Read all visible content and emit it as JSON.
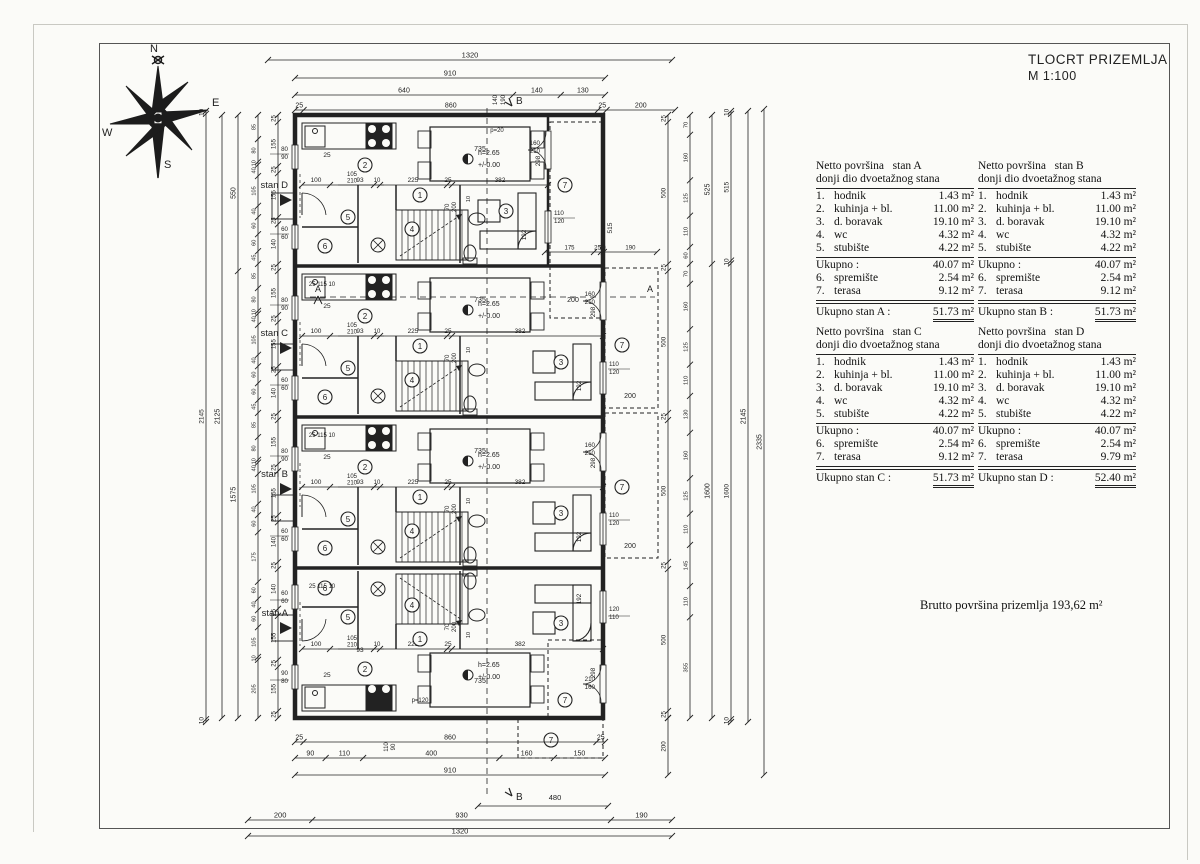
{
  "title_block": {
    "line1": "TLOCRT PRIZEMLJA",
    "line2": "M 1:100"
  },
  "compass": {
    "n": "N",
    "e": "E",
    "s": "S",
    "w": "W"
  },
  "brutto_text": "Brutto površina  prizemlja  193,62 m²",
  "tables": [
    {
      "header": "Netto površina   stan A\ndonji dio dvoetažnog stana",
      "rows": [
        [
          "1.",
          "hodnik",
          "1.43 m²"
        ],
        [
          "2.",
          "kuhinja + bl.",
          "11.00 m²"
        ],
        [
          "3.",
          "d. boravak",
          "19.10 m²"
        ],
        [
          "4.",
          "wc",
          "4.32 m²"
        ],
        [
          "5.",
          "stubište",
          "4.22 m²"
        ]
      ],
      "subtotal_label": "Ukupno :",
      "subtotal": "40.07 m²",
      "extra_rows": [
        [
          "6.",
          "spremište",
          "2.54 m²"
        ],
        [
          "7.",
          "terasa",
          "9.12 m²"
        ]
      ],
      "total_label": "Ukupno stan A :",
      "total": "51.73 m²"
    },
    {
      "header": "Netto površina   stan B\ndonji dio dvoetažnog stana",
      "rows": [
        [
          "1.",
          "hodnik",
          "1.43 m²"
        ],
        [
          "2.",
          "kuhinja + bl.",
          "11.00 m²"
        ],
        [
          "3.",
          "d. boravak",
          "19.10 m²"
        ],
        [
          "4.",
          "wc",
          "4.32 m²"
        ],
        [
          "5.",
          "stubište",
          "4.22 m²"
        ]
      ],
      "subtotal_label": "Ukupno :",
      "subtotal": "40.07 m²",
      "extra_rows": [
        [
          "6.",
          "spremište",
          "2.54 m²"
        ],
        [
          "7.",
          "terasa",
          "9.12 m²"
        ]
      ],
      "total_label": "Ukupno stan B :",
      "total": "51.73 m²"
    },
    {
      "header": "Netto površina   stan C\ndonji dio dvoetažnog stana",
      "rows": [
        [
          "1.",
          "hodnik",
          "1.43 m²"
        ],
        [
          "2.",
          "kuhinja + bl.",
          "11.00 m²"
        ],
        [
          "3.",
          "d. boravak",
          "19.10 m²"
        ],
        [
          "4.",
          "wc",
          "4.32 m²"
        ],
        [
          "5.",
          "stubište",
          "4.22 m²"
        ]
      ],
      "subtotal_label": "Ukupno :",
      "subtotal": "40.07 m²",
      "extra_rows": [
        [
          "6.",
          "spremište",
          "2.54 m²"
        ],
        [
          "7.",
          "terasa",
          "9.12 m²"
        ]
      ],
      "total_label": "Ukupno stan C :",
      "total": "51.73 m²"
    },
    {
      "header": "Netto površina   stan D\ndonji dio dvoetažnog stana",
      "rows": [
        [
          "1.",
          "hodnik",
          "1.43 m²"
        ],
        [
          "2.",
          "kuhinja + bl.",
          "11.00 m²"
        ],
        [
          "3.",
          "d. boravak",
          "19.10 m²"
        ],
        [
          "4.",
          "wc",
          "4.32 m²"
        ],
        [
          "5.",
          "stubište",
          "4.22 m²"
        ]
      ],
      "subtotal_label": "Ukupno :",
      "subtotal": "40.07 m²",
      "extra_rows": [
        [
          "6.",
          "spremište",
          "2.54 m²"
        ],
        [
          "7.",
          "terasa",
          "9.79 m²"
        ]
      ],
      "total_label": "Ukupno stan D :",
      "total": "52.40 m²"
    }
  ],
  "plan": {
    "units": [
      {
        "name": "stan D",
        "mirrored": false,
        "rw": 548,
        "p_label": "p=20",
        "label_rel": 73,
        "entry": ""
      },
      {
        "name": "stan C",
        "mirrored": false,
        "rw": 603,
        "p_label": "",
        "label_rel": 70,
        "entry": "25  115  10"
      },
      {
        "name": "stan B",
        "mirrored": false,
        "rw": 603,
        "p_label": "",
        "label_rel": 60,
        "entry": "25  115  10"
      },
      {
        "name": "stan A",
        "mirrored": true,
        "rw": 603,
        "p_label": "p=120",
        "label_rel": 48,
        "entry": "25  115  10"
      }
    ],
    "room_numbers": [
      "1",
      "2",
      "3",
      "4",
      "5",
      "6",
      "7"
    ],
    "level_height": "h=2.65",
    "level_zero": "+/-0.00",
    "table_width": "735",
    "corridor_dims": [
      "100",
      "105",
      "210",
      "10",
      "225",
      "25",
      "382"
    ],
    "kitchen_dims": {
      "k25": "25",
      "k93": "93"
    },
    "v298": "298",
    "v192": "192",
    "v10": "10",
    "win80": [
      "80",
      "90"
    ],
    "win60": [
      "60",
      "60"
    ],
    "win110": [
      "110",
      "120"
    ],
    "door160": [
      "160",
      "210"
    ],
    "door70": [
      "70",
      "200"
    ],
    "w110_90": [
      "110",
      "90"
    ],
    "w140_190": [
      "140",
      "190"
    ],
    "terrace": {
      "t200": "200",
      "t515": "515",
      "row": [
        "175",
        "25",
        "10",
        "190"
      ]
    },
    "section": {
      "a": "A",
      "b": "B",
      "b480": "480"
    },
    "chains": {
      "top": [
        [
          "1320"
        ],
        [
          "910"
        ],
        [
          "640",
          "140",
          "130"
        ],
        [
          "25",
          "860",
          "25",
          "200"
        ]
      ],
      "bottom": [
        [
          "25",
          "860",
          "25"
        ],
        [
          "90",
          "110",
          "400",
          "160",
          "150"
        ],
        [
          "910"
        ],
        [
          "200",
          "930",
          "190"
        ],
        [
          "1320"
        ]
      ],
      "b480_chain": [
        "480"
      ],
      "left": [
        [
          "25",
          "155",
          "25",
          "155",
          "25",
          "140",
          "25",
          "155",
          "25",
          "155",
          "25",
          "140",
          "25",
          "155",
          "25",
          "155",
          "25",
          "140",
          "25",
          "140",
          "25",
          "155",
          "25",
          "155",
          "25"
        ],
        [
          "85",
          "80",
          "10",
          "40",
          "105",
          "40",
          "60",
          "60",
          "45",
          "85",
          "80",
          "10",
          "40",
          "105",
          "40",
          "60",
          "60",
          "45",
          "85",
          "80",
          "10",
          "40",
          "105",
          "40",
          "60",
          "175",
          "60",
          "40",
          "60",
          "105",
          "10",
          "205"
        ],
        [
          "550",
          "1575"
        ],
        [
          "2125"
        ],
        [
          "10",
          "2145",
          "10"
        ]
      ],
      "right": [
        [
          "25",
          "500",
          "25",
          "500",
          "25",
          "500",
          "25",
          "500",
          "25"
        ],
        [
          "70",
          "160",
          "125",
          "110",
          "60",
          "70",
          "160",
          "125",
          "110",
          "130",
          "160",
          "125",
          "110",
          "145",
          "110",
          "355"
        ],
        [
          "525",
          "1600"
        ],
        [
          "10",
          "515",
          "10",
          "1600",
          "10"
        ],
        [
          "2145"
        ],
        [
          "2335"
        ]
      ],
      "r200": [
        "200"
      ]
    }
  }
}
